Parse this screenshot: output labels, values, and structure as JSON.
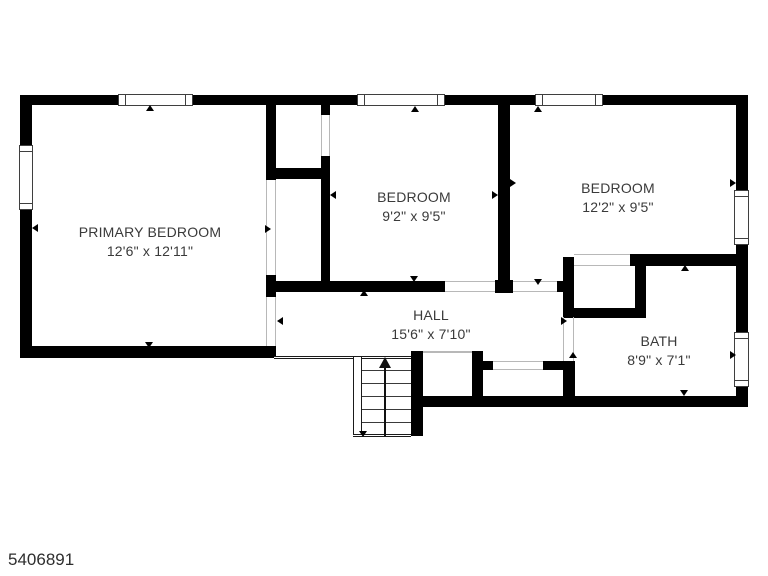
{
  "floorplan": {
    "rooms": [
      {
        "name": "PRIMARY BEDROOM",
        "dims": "12'6\" x 12'11\""
      },
      {
        "name": "BEDROOM",
        "dims": "9'2\" x 9'5\""
      },
      {
        "name": "BEDROOM",
        "dims": "12'2\" x 9'5\""
      },
      {
        "name": "HALL",
        "dims": "15'6\" x 7'10\""
      },
      {
        "name": "BATH",
        "dims": "8'9\" x 7'1\""
      }
    ],
    "listing_id": "5406891",
    "colors": {
      "wall": "#000000",
      "text": "#3a3a3a",
      "background": "#ffffff",
      "opening_line": "#b8b8b8"
    }
  }
}
